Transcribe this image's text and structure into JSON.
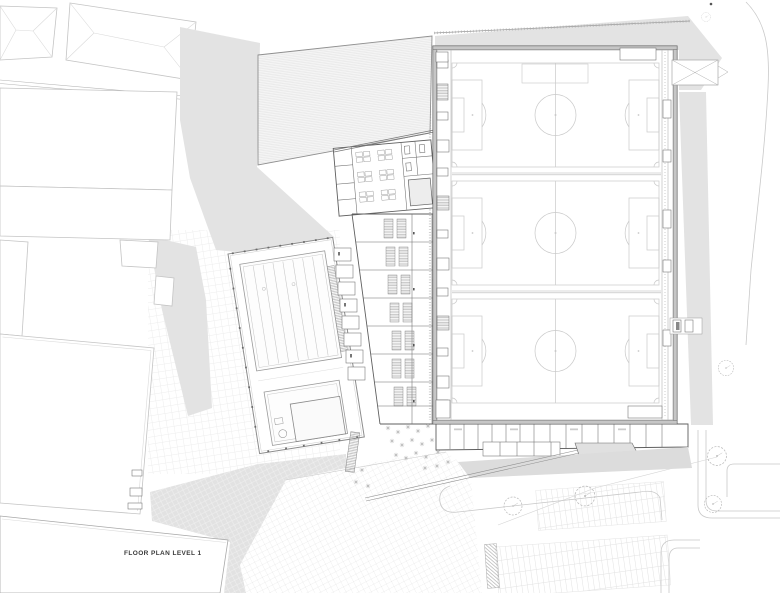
{
  "page": {
    "background": "#ffffff"
  },
  "drawing": {
    "label": "FLOOR PLAN LEVEL 1",
    "label_color": "#3a3a3a"
  },
  "site": {
    "context_fill": "#e3e3e3",
    "context_fill_dark": "#dcdcdc",
    "road_line_color": "#c9c9c9",
    "paving_grid_color": "#ededed"
  },
  "building": {
    "wall_color": "#5f5f5f",
    "hall_wall_fill": "#c6c6c6",
    "field_line_color": "#c9c9c9",
    "pool_line_color": "#9a9a9a",
    "football_fields_count": 3,
    "swimming_pools_count": 2,
    "trees_count": 6
  }
}
